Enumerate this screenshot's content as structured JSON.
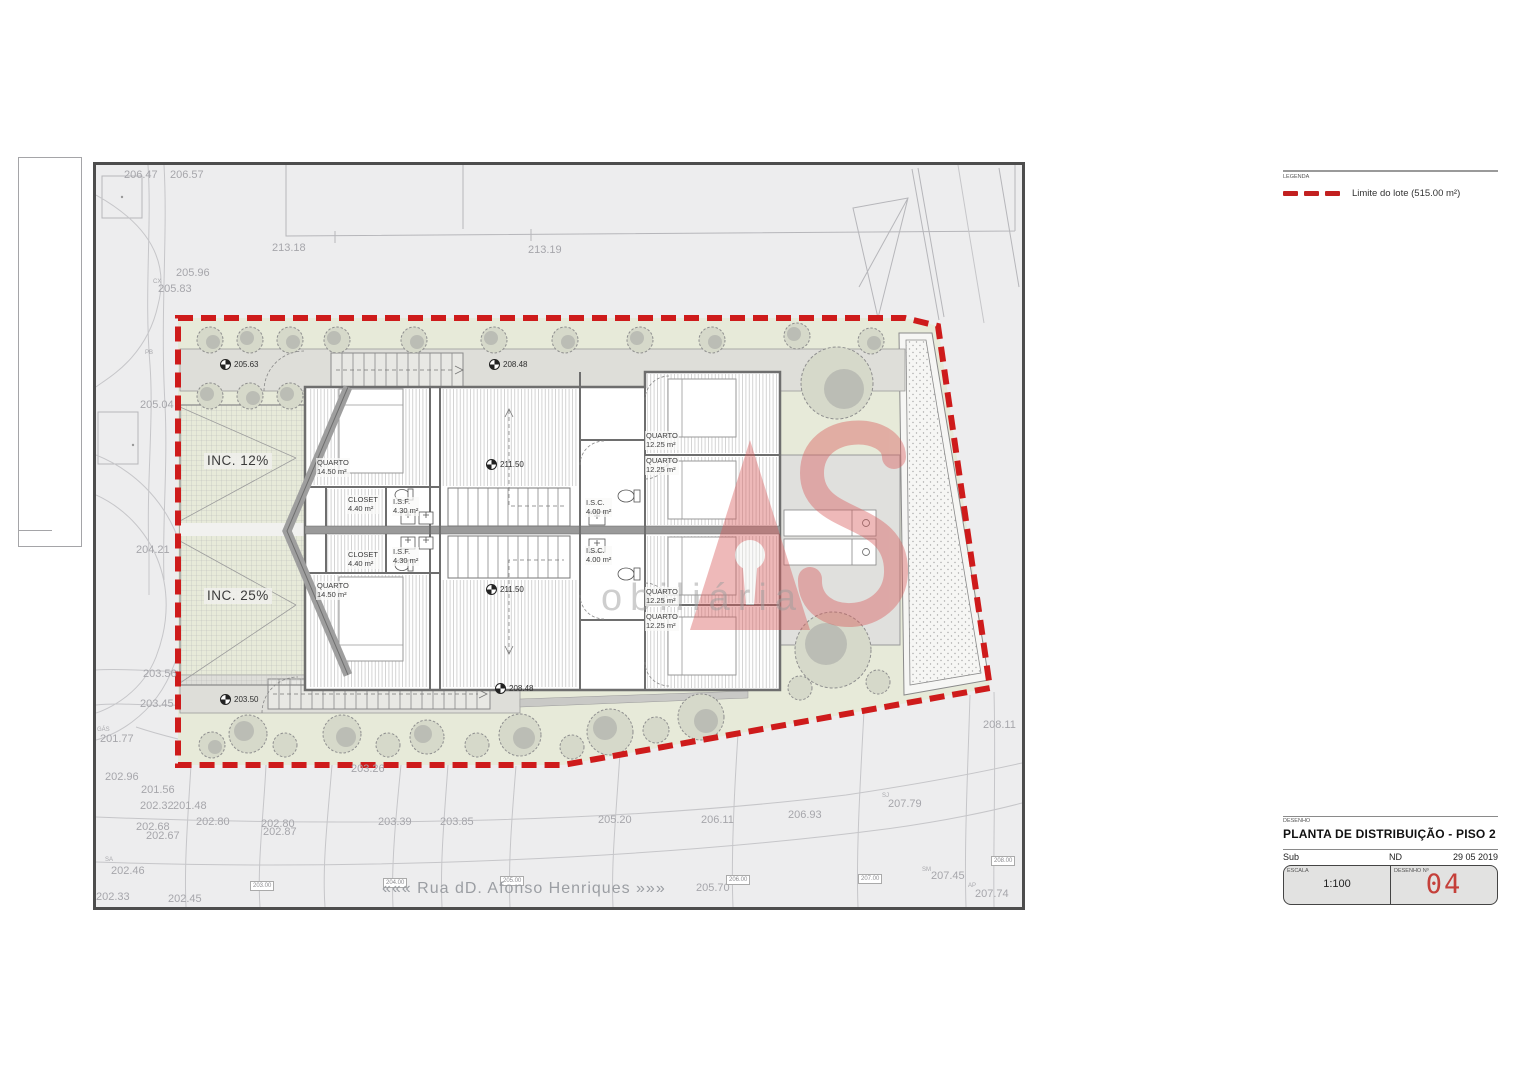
{
  "legend": {
    "title": "LEGENDA",
    "lot_limit_label": "Limite do lote (515.00 m²)"
  },
  "title_block": {
    "drawing_label": "DESENHO",
    "drawing_title": "PLANTA DE DISTRIBUIÇÃO - PISO 2",
    "sub_label": "Sub",
    "nd_label": "ND",
    "date": "29 05 2019",
    "scale_label": "ESCALA",
    "scale_value": "1:100",
    "number_label": "DESENHO Nº",
    "number_value": "04"
  },
  "watermark": {
    "brand_text": "obiliária"
  },
  "plan": {
    "street_name": "««« Rua dD. Afonso Henriques »»»",
    "ramps": [
      {
        "label": "INC. 12%"
      },
      {
        "label": "INC. 25%"
      }
    ],
    "rooms": [
      {
        "name": "QUARTO",
        "area": "14.50 m²"
      },
      {
        "name": "QUARTO",
        "area": "14.50 m²"
      },
      {
        "name": "CLOSET",
        "area": "4.40 m²"
      },
      {
        "name": "CLOSET",
        "area": "4.40 m²"
      },
      {
        "name": "I.S.F.",
        "area": "4.30 m²"
      },
      {
        "name": "I.S.F.",
        "area": "4.30 m²"
      },
      {
        "name": "I.S.C.",
        "area": "4.00 m²"
      },
      {
        "name": "I.S.C.",
        "area": "4.00 m²"
      },
      {
        "name": "QUARTO",
        "area": "12.25 m²"
      },
      {
        "name": "QUARTO",
        "area": "12.25 m²"
      },
      {
        "name": "QUARTO",
        "area": "12.25 m²"
      },
      {
        "name": "QUARTO",
        "area": "12.25 m²"
      }
    ],
    "level_markers": [
      {
        "value": "205.63"
      },
      {
        "value": "208.48"
      },
      {
        "value": "211.50"
      },
      {
        "value": "211.50"
      },
      {
        "value": "208.48"
      },
      {
        "value": "203.50"
      }
    ],
    "contour_labels": [
      {
        "value": "203.00"
      },
      {
        "value": "204.00"
      },
      {
        "value": "205.00"
      },
      {
        "value": "206.00"
      },
      {
        "value": "207.00"
      },
      {
        "value": "208.00"
      }
    ],
    "elevations": [
      {
        "value": "206.47"
      },
      {
        "value": "206.57"
      },
      {
        "value": "213.18"
      },
      {
        "value": "213.19"
      },
      {
        "value": "205.96"
      },
      {
        "value": "205.83"
      },
      {
        "value": "205.04"
      },
      {
        "value": "204.21"
      },
      {
        "value": "203.56"
      },
      {
        "value": "203.45"
      },
      {
        "value": "201.77"
      },
      {
        "value": "202.96"
      },
      {
        "value": "201.56"
      },
      {
        "value": "202.32"
      },
      {
        "value": "201.48"
      },
      {
        "value": "202.68"
      },
      {
        "value": "202.67"
      },
      {
        "value": "202.80"
      },
      {
        "value": "202.80"
      },
      {
        "value": "202.87"
      },
      {
        "value": "203.39"
      },
      {
        "value": "203.26"
      },
      {
        "value": "203.85"
      },
      {
        "value": "205.20"
      },
      {
        "value": "206.11"
      },
      {
        "value": "206.93"
      },
      {
        "value": "207.79"
      },
      {
        "value": "208.11"
      },
      {
        "value": "205.70"
      },
      {
        "value": "207.45"
      },
      {
        "value": "207.74"
      },
      {
        "value": "202.46"
      },
      {
        "value": "202.33"
      },
      {
        "value": "202.45"
      }
    ],
    "survey_codes": [
      {
        "code": "CX"
      },
      {
        "code": "PB"
      },
      {
        "code": "GÁS"
      },
      {
        "code": "SJ"
      },
      {
        "code": "SM"
      },
      {
        "code": "AP"
      },
      {
        "code": "SA"
      }
    ]
  },
  "colors": {
    "lot_boundary": "#ce1b1b",
    "garden": "#e7ead9",
    "walkway": "#dedeD9",
    "frame": "#4d4d4d",
    "drawing_number": "#c5403a",
    "watermark": "#d95b5b"
  }
}
